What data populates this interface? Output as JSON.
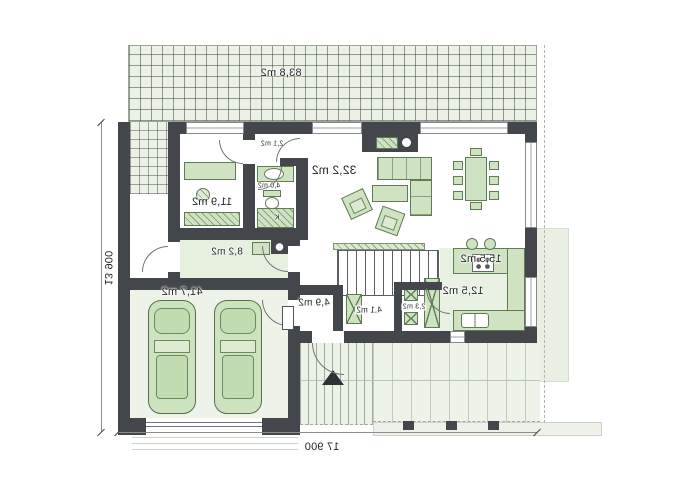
{
  "rooms": {
    "terrace": {
      "area": "83,8 m2"
    },
    "living_room": {
      "area": "32,2 m2"
    },
    "dining_room": {
      "area": "15,5 m2"
    },
    "kitchen": {
      "area": "12,5 m2"
    },
    "pantry": {
      "area": "2,3 m2"
    },
    "corridor": {
      "area": "4,1 m2"
    },
    "hall": {
      "area": "4,9 m2"
    },
    "utility_room": {
      "area": "8,2 m2"
    },
    "garage": {
      "area": "41,7 m2"
    },
    "bedroom": {
      "area": "11,9 m2"
    },
    "bathroom": {
      "area": "4,0 m2"
    },
    "vestibule": {
      "area": "2,1 m2"
    }
  },
  "dimensions": {
    "overall_width": "17 900",
    "overall_depth": "13 900"
  },
  "marks": {
    "fixture_mark": "K"
  },
  "colors": {
    "wall": "#43474b",
    "furniture_fill": "#cfe3c2",
    "furniture_stroke": "#5e7d52",
    "paving": "#ebf1e6",
    "floor_tint": "#e9f1e2"
  }
}
